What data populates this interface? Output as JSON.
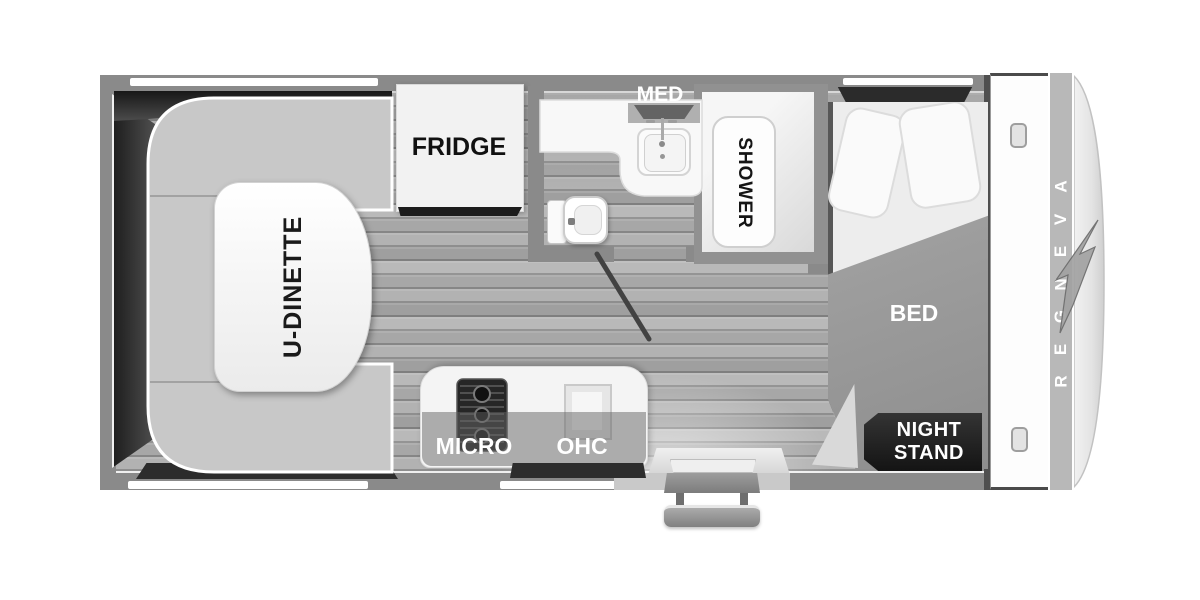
{
  "floorplan": {
    "brand": "AVENGER",
    "labels": {
      "dinette": "U-DINETTE",
      "fridge": "FRIDGE",
      "med": "MED",
      "shower": "SHOWER",
      "bed": "BED",
      "nightstand_line1": "NIGHT",
      "nightstand_line2": "STAND",
      "micro": "MICRO",
      "ohc": "OHC"
    },
    "colors": {
      "wall": "#8a8a8a",
      "floor": "#afafaf",
      "furniture_white": "#f4f4f4",
      "bench_gray": "#c8c8c8",
      "blanket_gray": "#9c9c9c",
      "dark_accent": "#262626",
      "label_dark": "#1a1a1a",
      "label_light": "#ffffff",
      "cap_band": "#b8b8b8"
    }
  }
}
